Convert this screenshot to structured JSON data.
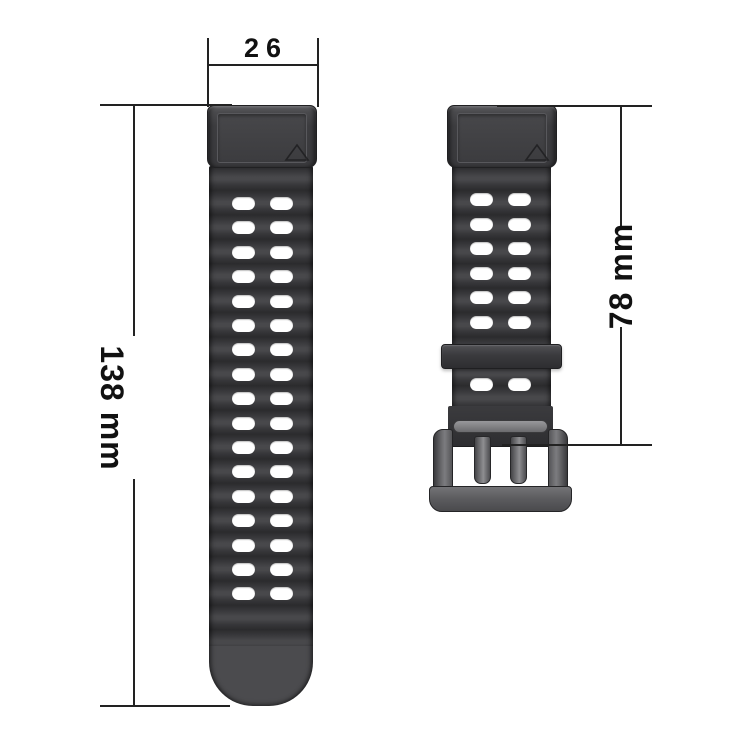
{
  "diagram": {
    "labels": {
      "band_width": "26",
      "long_strap_length": "138 mm",
      "short_strap_length": "78 mm"
    },
    "long_strap": {
      "hole_rows": 17,
      "holes_per_row": 2
    },
    "short_strap": {
      "hole_rows_above_keeper": 6,
      "hole_rows_below_keeper": 1,
      "holes_per_row": 2
    },
    "colors": {
      "background": "#ffffff",
      "dimension_line": "#222222",
      "label_text": "#111111",
      "strap_dark": "#2b2b2d",
      "rib_highlight": "#48484b",
      "rib_shadow": "#2b2b2d",
      "tail": "#4b4b4e",
      "hole": "#ffffff",
      "buckle_metal": "#6e6e71"
    }
  }
}
